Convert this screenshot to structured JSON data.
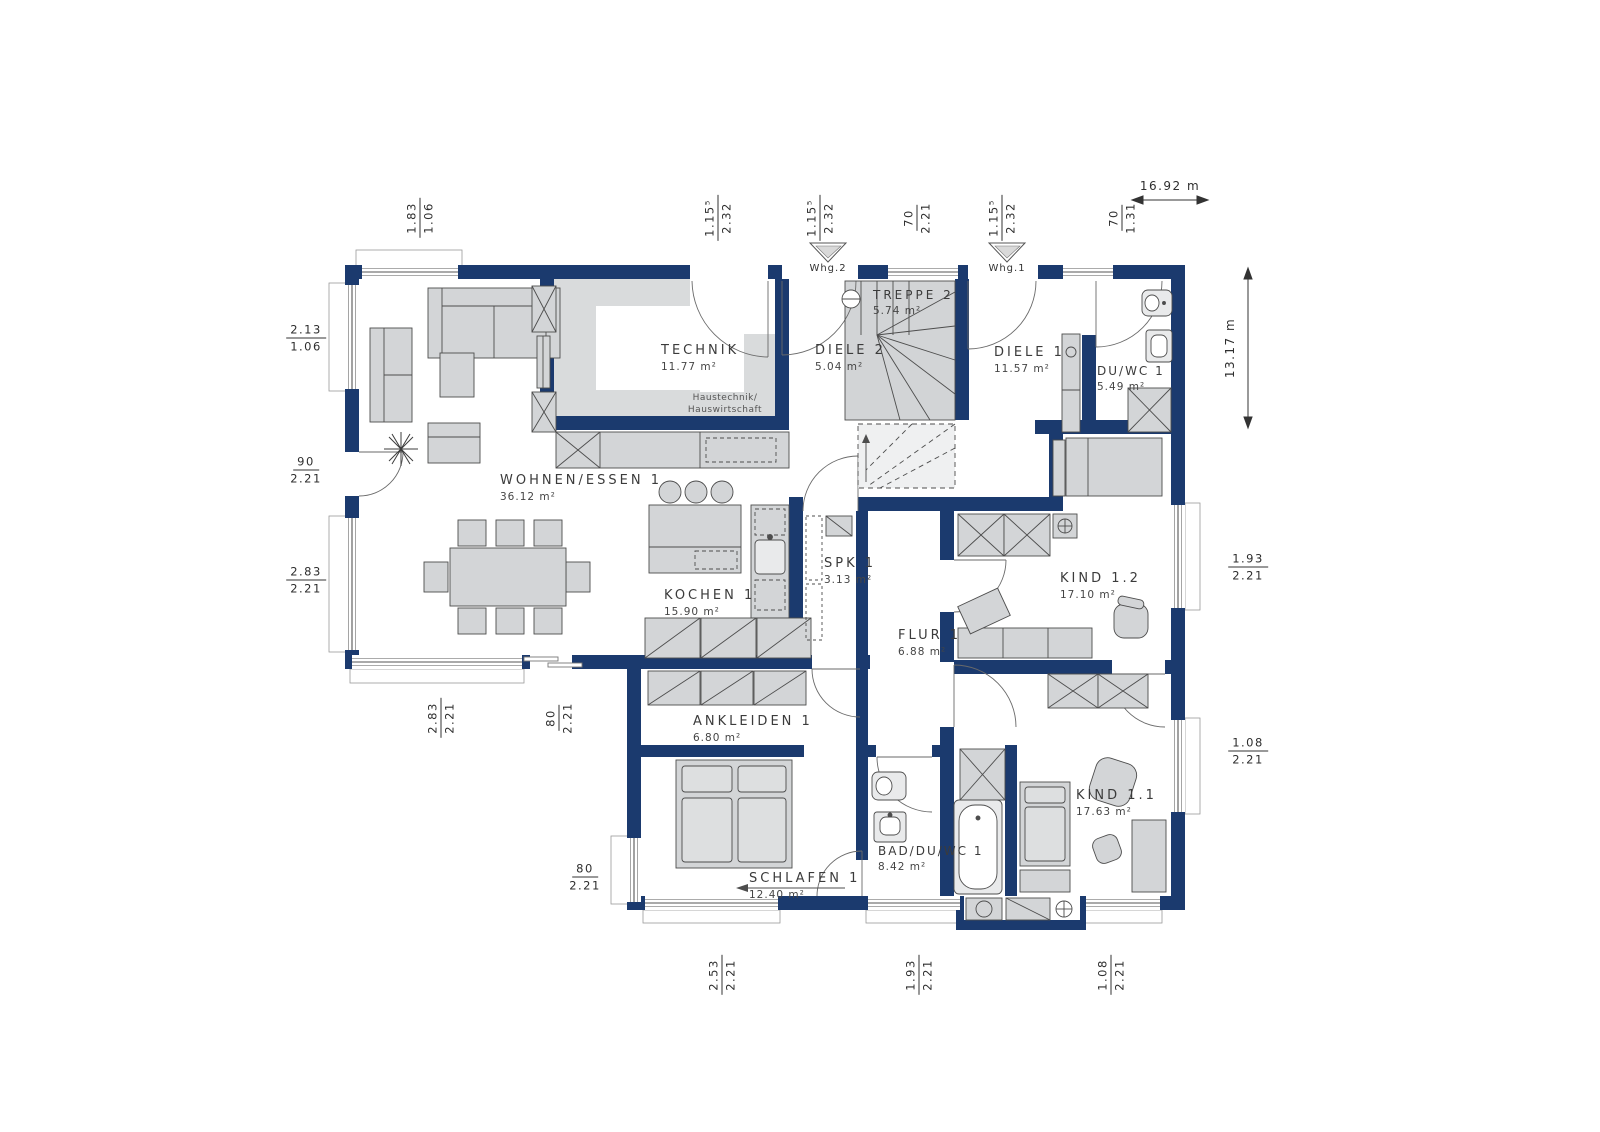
{
  "colors": {
    "wall_navy": "#1b3a6e",
    "floor_gray": "#d9dbdc",
    "furniture_gray": "#d3d5d7",
    "outline_gray": "#4d4d4d",
    "text_gray": "#3b3b3b"
  },
  "overall_dims": {
    "width_label": "16.92 m",
    "height_label": "13.17 m"
  },
  "unit_markers": [
    {
      "label": "Whg.2"
    },
    {
      "label": "Whg.1"
    }
  ],
  "technik_note": {
    "line1": "Haustechnik/",
    "line2": "Hauswirtschaft"
  },
  "rooms": [
    {
      "name": "TECHNIK",
      "area": "11.77 m²"
    },
    {
      "name": "DIELE 2",
      "area": "5.04 m²"
    },
    {
      "name": "TREPPE 2",
      "area": "5.74 m²"
    },
    {
      "name": "DIELE 1",
      "area": "11.57 m²"
    },
    {
      "name": "DU/WC 1",
      "area": "5.49 m²"
    },
    {
      "name": "WOHNEN/ESSEN 1",
      "area": "36.12 m²"
    },
    {
      "name": "KOCHEN 1",
      "area": "15.90 m²"
    },
    {
      "name": "SPK 1",
      "area": "3.13 m²"
    },
    {
      "name": "FLUR 1",
      "area": "6.88 m²"
    },
    {
      "name": "KIND 1.2",
      "area": "17.10 m²"
    },
    {
      "name": "ANKLEIDEN 1",
      "area": "6.80 m²"
    },
    {
      "name": "SCHLAFEN 1",
      "area": "12.40 m²"
    },
    {
      "name": "BAD/DU/WC 1",
      "area": "8.42 m²"
    },
    {
      "name": "KIND 1.1",
      "area": "17.63 m²"
    }
  ],
  "dimensions": {
    "top": [
      {
        "upper": "1.83",
        "lower": "1.06"
      },
      {
        "upper": "1.15⁵",
        "lower": "2.32"
      },
      {
        "upper": "1.15⁵",
        "lower": "2.32"
      },
      {
        "upper": "70",
        "lower": "2.21"
      },
      {
        "upper": "1.15⁵",
        "lower": "2.32"
      },
      {
        "upper": "70",
        "lower": "1.31"
      }
    ],
    "left": [
      {
        "upper": "2.13",
        "lower": "1.06"
      },
      {
        "upper": "90",
        "lower": "2.21"
      },
      {
        "upper": "2.83",
        "lower": "2.21"
      }
    ],
    "left_lower": [
      {
        "upper": "80",
        "lower": "2.21"
      }
    ],
    "inner_bottom": [
      {
        "upper": "2.83",
        "lower": "2.21"
      },
      {
        "upper": "80",
        "lower": "2.21"
      }
    ],
    "bottom": [
      {
        "upper": "2.53",
        "lower": "2.21"
      },
      {
        "upper": "1.93",
        "lower": "2.21"
      },
      {
        "upper": "1.08",
        "lower": "2.21"
      }
    ],
    "right": [
      {
        "upper": "1.93",
        "lower": "2.21"
      },
      {
        "upper": "1.08",
        "lower": "2.21"
      }
    ]
  }
}
